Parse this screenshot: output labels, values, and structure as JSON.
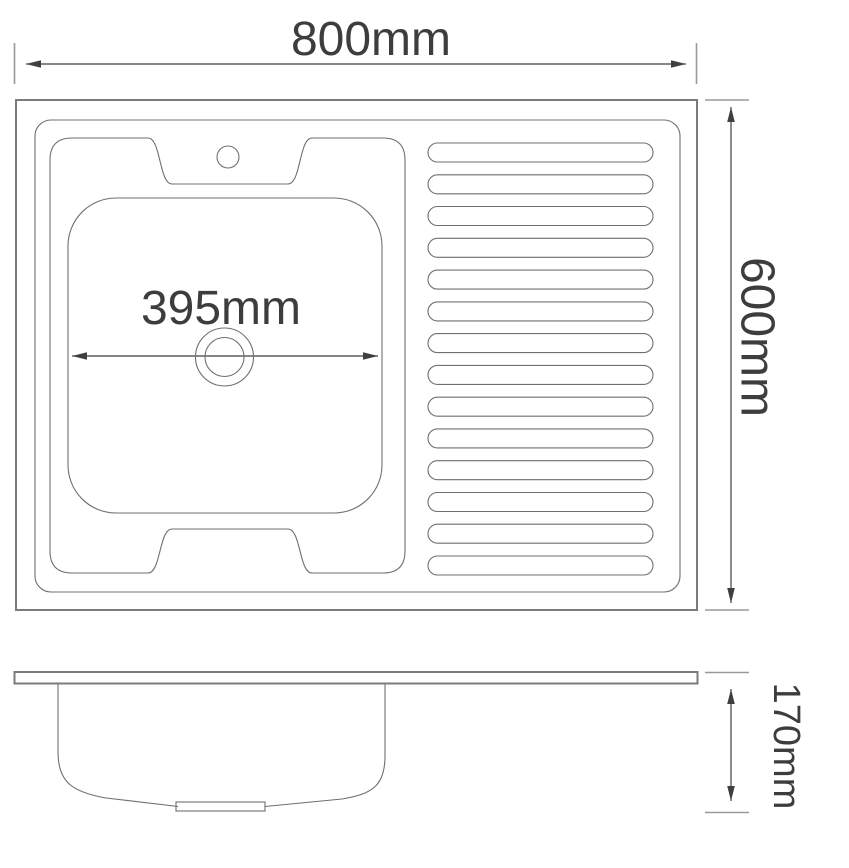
{
  "title": "Kitchen sink with drainboard - dimensioned technical drawing",
  "dimensions": {
    "overall_width_label": "800mm",
    "overall_depth_label": "600mm",
    "basin_width_label": "395mm",
    "bowl_depth_label": "170mm"
  },
  "plan": {
    "drainboard": {
      "rib_count": 14
    }
  },
  "colors": {
    "background": "#ffffff",
    "edge": "#7b7b7b",
    "line": "#6f6f6f",
    "dim_line": "#3f3f3f",
    "extension": "#9a9a9a",
    "text": "#3d3d3d"
  }
}
